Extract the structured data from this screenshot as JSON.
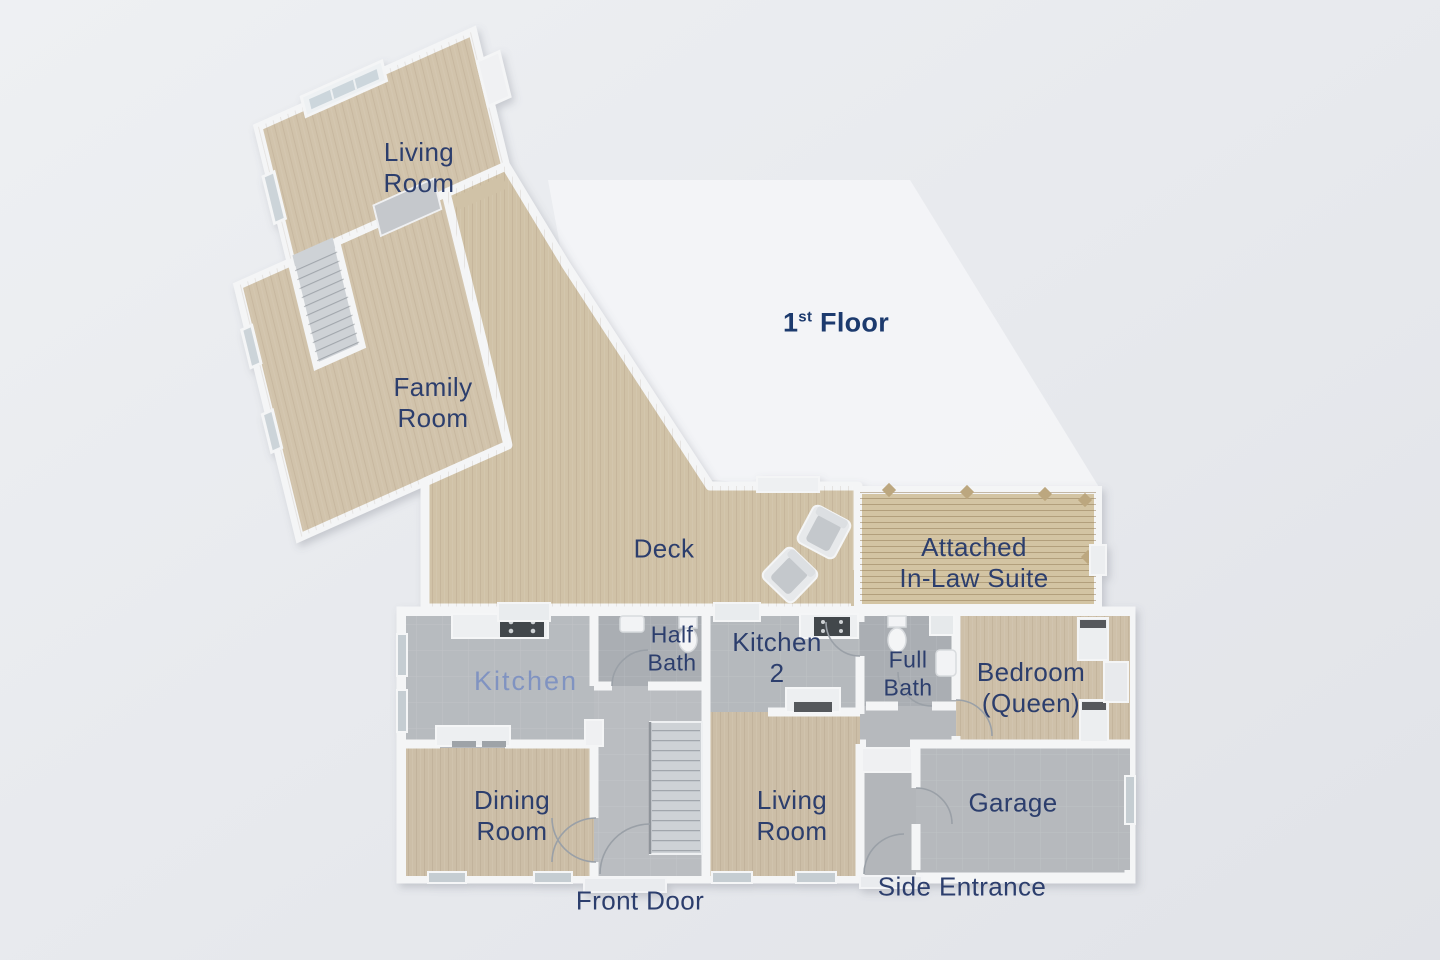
{
  "title": {
    "num": "1",
    "sup": "st",
    "rest": " Floor"
  },
  "labels": {
    "living_upper": "Living\nRoom",
    "family": "Family\nRoom",
    "deck": "Deck",
    "inlaw": "Attached\nIn-Law Suite",
    "kitchen": "Kitchen",
    "half_bath": "Half\nBath",
    "kitchen2": "Kitchen\n2",
    "full_bath": "Full\nBath",
    "bedroom": "Bedroom\n(Queen)",
    "dining": "Dining\nRoom",
    "living_lower": "Living\nRoom",
    "garage": "Garage",
    "front_door": "Front Door",
    "side_entrance": "Side Entrance"
  },
  "colors": {
    "bg1": "#eef0f3",
    "bg2": "#e1e3e8",
    "white_region": "#f4f5f7",
    "wall": "#f4f5f6",
    "wood": "#d1c3ab",
    "wood_deck": "#d0c2a7",
    "wood_planks": "#d3c4a3",
    "gray_floor": "#b6b9bd",
    "bath_gray": "#aaaeb3",
    "stair_gray": "#ced2d6",
    "navy": "#2c3e6d",
    "title_navy": "#1c3a6e",
    "kitchen_label": "#8093c1"
  }
}
